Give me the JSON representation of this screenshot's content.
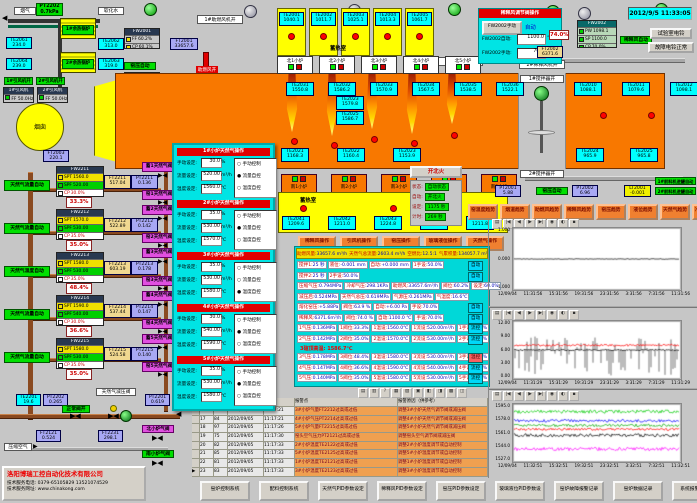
{
  "window": {
    "datetime": "2012/9/5 11:33:05"
  },
  "colors": {
    "bg": "#c6c6c6",
    "furnace": "#f87800",
    "regen_yellow": "#ffff00",
    "sensor_cyan": "#00ffff",
    "sensor_purple": "#a8a8f4",
    "auto_green": "#00e000",
    "alarm_red": "#e00000",
    "trend_btn_orange": "#f08030",
    "popup_cyan": "#00e4e4"
  },
  "glyphs": {
    "valve": "▶◀",
    "arrow_left": "◀",
    "arrow_right": "▶"
  },
  "top_left": {
    "flue_gas": "烟气",
    "soft_water": "软化水",
    "chimney": "烟囱",
    "kiln_auto": "窑压自动",
    "comb_air_on": "助燃风开",
    "comb_fan_on": "1#助燃风机开",
    "pt2202": {
      "id": "PT2202",
      "v": "0.7kPa"
    },
    "boiler1": "1#余热锅炉",
    "boiler2": "2#余热锅炉",
    "te2061": {
      "id": "TE2061",
      "v": "234.0"
    },
    "te2064": {
      "id": "TE2064",
      "v": "239.0"
    },
    "te2062": {
      "id": "TE2062",
      "v": "313.0"
    },
    "te2063": {
      "id": "TE2063",
      "v": "319.0"
    },
    "ft2003": {
      "id": "FT2003",
      "v": "220.1"
    },
    "te2053": {
      "id": "TE2053",
      "v": "745.7"
    },
    "ft2001": {
      "id": "FT2001",
      "v": "33657.6"
    },
    "fan1_on": "1#引风机开",
    "fan2_on": "2#引风机开",
    "fan1": {
      "name": "1#引风机",
      "rows": [
        {
          "k": "FF",
          "v": "50.0Hz"
        }
      ]
    },
    "fan2": {
      "name": "2#引风机",
      "rows": [
        {
          "k": "FF",
          "v": "50.0Hz"
        }
      ]
    },
    "fw2001_top": {
      "title": "FW2001",
      "rows": [
        {
          "k": "FF",
          "v": "60.2%"
        },
        {
          "k": "CP",
          "v": "60.1%"
        }
      ]
    },
    "fw2001": {
      "title": "FW2001",
      "rows": [
        {
          "k": "PF",
          "v": "5.88"
        },
        {
          "k": "SP",
          "v": "6.00"
        },
        {
          "k": "OP",
          "v": "78.0%"
        }
      ]
    },
    "valve_pos": "63.9%"
  },
  "furnace": {
    "regen_label": "蓄热室",
    "south_regen_label": "蓄热室",
    "regen_top": [
      {
        "id": "TE2001",
        "v": "1040.1"
      },
      {
        "id": "TE2002",
        "v": "1011.7"
      },
      {
        "id": "TE2003",
        "v": "1025.1"
      },
      {
        "id": "TE2004",
        "v": "1013.3"
      },
      {
        "id": "TE2005",
        "v": "1061.7"
      }
    ],
    "north_ports": [
      "北1小炉",
      "北2小炉",
      "北3小炉",
      "北4小炉",
      "北5小炉"
    ],
    "south_ports": [
      "南1小炉",
      "南2小炉",
      "南3小炉",
      "南4小炉",
      "南5小炉"
    ],
    "crown_temps": [
      {
        "id": "TE2031",
        "v": "1550.8"
      },
      {
        "id": "TE2032",
        "v": "1586.2"
      },
      {
        "id": "TE2033",
        "v": "1570.9"
      },
      {
        "id": "TE2034",
        "v": "1567.5"
      },
      {
        "id": "TE2035",
        "v": "1538.5"
      },
      {
        "id": "TE2036",
        "v": "1522.1"
      }
    ],
    "right_temps": [
      {
        "id": "TE2010",
        "v": "1088.1"
      },
      {
        "id": "TE2011",
        "v": "1079.6"
      },
      {
        "id": "TE2012",
        "v": "1098.1"
      }
    ],
    "mid_temps": [
      {
        "id": "TE2023",
        "v": "1579.8"
      },
      {
        "id": "TE2025",
        "v": "1586.7"
      }
    ],
    "bottom_temps": [
      {
        "id": "TE2021",
        "v": "1168.3"
      },
      {
        "id": "TE2022",
        "v": "1160.4"
      },
      {
        "id": "TE2023",
        "v": "1153.9"
      }
    ],
    "bottom_temps2": [
      {
        "id": "TE2024",
        "v": "965.9"
      },
      {
        "id": "TE2025",
        "v": "965.8"
      }
    ],
    "south_regen": [
      {
        "id": "TE2041",
        "v": "1209.6"
      },
      {
        "id": "TE2042",
        "v": "1211.0"
      },
      {
        "id": "TE2043",
        "v": "1224.8"
      },
      {
        "id": "TE2044",
        "v": "1212.8"
      },
      {
        "id": "TE2045",
        "v": "1211.8"
      }
    ],
    "mixer1": "1#搅拌器开",
    "mixer2": "2#搅拌器开",
    "dil1": "1#稀释风机开",
    "dil2": "2#稀释风机开"
  },
  "top_right": {
    "panel": {
      "title": "稀释风调节阀操作",
      "btn": "FW2002手动",
      "mode": "自动",
      "auto_label": "FW2002自动:",
      "auto_value": "1100.0",
      "auto_unit": "℃",
      "man_label": "FW2002手动:",
      "man_value": "70.0",
      "man_unit": "%"
    },
    "fw2002": {
      "title": "FW2002",
      "rows": [
        {
          "k": "PW",
          "v": "1098.1"
        },
        {
          "k": "SP",
          "v": "1100.0"
        },
        {
          "k": "CP",
          "v": "70.0%"
        }
      ]
    },
    "valve_pos": "74.0%",
    "ft2002": {
      "id": "FT2002",
      "v": "6371.6"
    },
    "dilution_auto": "稀释风自动",
    "bell_test": "试验室电铃",
    "bell_ok": "故障电铃正常"
  },
  "level_group": {
    "pt2001": {
      "id": "PT2001",
      "v": "5.88"
    },
    "kiln_auto": "窑压自动",
    "pt2002": {
      "id": "PT2002",
      "v": "6.96"
    },
    "lt2001": {
      "id": "LT2001",
      "v": "-0.001"
    },
    "feeder1": "1#前料机进罐自动",
    "feeder2": "2#前料机进罐自动"
  },
  "fire_control": {
    "button": "开北火",
    "rows": [
      {
        "k": "状态:",
        "v": "自动状态"
      },
      {
        "k": "自动:",
        "v": "开北火"
      },
      {
        "k": "设定:",
        "v": "1175 秒"
      },
      {
        "k": "计时:",
        "v": "269 秒"
      }
    ]
  },
  "op_buttons": [
    "稀释风操作",
    "引风机操作",
    "窑压操作",
    "玻璃液位操作",
    "天然气操作"
  ],
  "trend_buttons": [
    "窑温度趋势",
    "烟道趋势",
    "助燃风趋势",
    "稀释风趋势",
    "窑压趋势",
    "液位趋势",
    "天然气趋势",
    "冷却气趋势"
  ],
  "gas_loops": [
    {
      "auto": "天然气流量自动",
      "fw": "FW2211",
      "rows": [
        {
          "k": "SPT",
          "v": "1560.0"
        },
        {
          "k": "SPF",
          "v": "520.00"
        },
        {
          "k": "CP",
          "v": "30.0%"
        }
      ],
      "ft": {
        "id": "FT2211",
        "v": "517.04"
      },
      "pt": {
        "id": "PT2211",
        "v": "0.136"
      },
      "pos": "33.3%",
      "valve_top": "蓄1天然气阀",
      "valve_bottom": "窑1天然气阀"
    },
    {
      "auto": "天然气流量自动",
      "fw": "FW2212",
      "rows": [
        {
          "k": "SPT",
          "v": "1570.0"
        },
        {
          "k": "SPF",
          "v": "530.00"
        },
        {
          "k": "CP",
          "v": "35.0%"
        }
      ],
      "ft": {
        "id": "FT2212",
        "v": "522.89"
      },
      "pt": {
        "id": "PT2212",
        "v": "0.142"
      },
      "pos": "35.0%",
      "valve_top": "蓄2天然气阀",
      "valve_bottom": "窑2天然气阀"
    },
    {
      "auto": "天然气温度自动",
      "fw": "FW2213",
      "rows": [
        {
          "k": "SPT",
          "v": "1580.0"
        },
        {
          "k": "SPF",
          "v": "530.00"
        },
        {
          "k": "CP",
          "v": "35.0%"
        }
      ],
      "ft": {
        "id": "FT2213",
        "v": "603.19"
      },
      "pt": {
        "id": "PT2213",
        "v": "0.178"
      },
      "pos": "48.4%",
      "valve_top": "蓄3天然气阀",
      "valve_bottom": "窑3天然气阀"
    },
    {
      "auto": "天然气流量自动",
      "fw": "FW2214",
      "rows": [
        {
          "k": "SPT",
          "v": "1590.0"
        },
        {
          "k": "SPF",
          "v": "540.00"
        },
        {
          "k": "CP",
          "v": "30.0%"
        }
      ],
      "ft": {
        "id": "FT2214",
        "v": "537.44"
      },
      "pt": {
        "id": "PT2214",
        "v": "0.147"
      },
      "pos": "36.6%",
      "valve_top": "蓄4天然气阀",
      "valve_bottom": "窑4天然气阀"
    },
    {
      "auto": "天然气流量自动",
      "fw": "FW2215",
      "rows": [
        {
          "k": "SPT",
          "v": "1580.0"
        },
        {
          "k": "SPF",
          "v": "530.00"
        },
        {
          "k": "CP",
          "v": "35.0%"
        }
      ],
      "ft": {
        "id": "FT2215",
        "v": "524.58"
      },
      "pt": {
        "id": "PT2215",
        "v": "0.140"
      },
      "pos": "35.0%",
      "valve_top": "蓄5天然气阀",
      "valve_bottom": "窑5天然气阀"
    }
  ],
  "popup": {
    "labels": {
      "manual": "手动设定:",
      "flow": "流量设定:",
      "temp": "温度设定:",
      "um": "%",
      "uf": "m³/h",
      "ut": "℃"
    },
    "sections": [
      {
        "title": "1#小炉天然气操作",
        "manual": "30.0",
        "flow": "520.00",
        "temp": "1560.0",
        "radios": [
          {
            "s": "○",
            "l": "手动控制"
          },
          {
            "s": "●",
            "l": "流量自控"
          },
          {
            "s": "○",
            "l": "温度自控"
          }
        ]
      },
      {
        "title": "2#小炉天然气操作",
        "manual": "35.0",
        "flow": "530.00",
        "temp": "1570.0",
        "radios": [
          {
            "s": "○",
            "l": "手动控制"
          },
          {
            "s": "●",
            "l": "流量自控"
          },
          {
            "s": "○",
            "l": "温度自控"
          }
        ]
      },
      {
        "title": "3#小炉天然气操作",
        "manual": "35.0",
        "flow": "530.00",
        "temp": "1580.0",
        "radios": [
          {
            "s": "○",
            "l": "手动控制"
          },
          {
            "s": "○",
            "l": "流量自控"
          },
          {
            "s": "●",
            "l": "温度自控"
          }
        ]
      },
      {
        "title": "4#小炉天然气操作",
        "manual": "30.0",
        "flow": "540.00",
        "temp": "1590.0",
        "radios": [
          {
            "s": "○",
            "l": "手动控制"
          },
          {
            "s": "●",
            "l": "流量自控"
          },
          {
            "s": "○",
            "l": "温度自控"
          }
        ]
      },
      {
        "title": "5#小炉天然气操作",
        "manual": "35.0",
        "flow": "530.00",
        "temp": "1580.0",
        "radios": [
          {
            "s": "○",
            "l": "手动控制"
          },
          {
            "s": "●",
            "l": "流量自控"
          },
          {
            "s": "○",
            "l": "温度自控"
          }
        ]
      }
    ]
  },
  "banner": {
    "items": [
      {
        "k": "助燃风量:",
        "v": "33657.6 m³/h"
      },
      {
        "k": "天然气总流量:",
        "v": "2603.4 m³/h"
      },
      {
        "k": "空燃比:",
        "v": "12.5:1"
      },
      {
        "k": "气累积量:",
        "v": "134057.7 m³"
      }
    ]
  },
  "grid": {
    "rows": [
      [
        {
          "k": "搅拌1:",
          "v": "25 秒"
        },
        {
          "k": "液位:",
          "v": "-0.001 mm"
        },
        {
          "k": "自动:",
          "v": "+0.000 mm"
        },
        {
          "k": "1手设:",
          "v": "50.0%"
        }
      ],
      [
        {
          "k": "搅拌2:",
          "v": "25 秒"
        },
        {
          "k": "2手设:",
          "v": "50.0%"
        }
      ],
      [
        {
          "k": "压缩气压:",
          "v": "0.794MPa"
        },
        {
          "k": "冷却气压:",
          "v": "298.1KPa"
        },
        {
          "k": "助燃风:",
          "v": "33657.6m³/h"
        },
        {
          "k": "阀位:",
          "v": "60.2%"
        },
        {
          "k": "设定:",
          "v": "60.0%"
        }
      ],
      [
        {
          "k": "减压后:",
          "v": "0.524MPa"
        },
        {
          "k": "天然气总压:",
          "v": "0.619MPa"
        },
        {
          "k": "气源压:",
          "v": "0.261MPa"
        },
        {
          "k": "气温度:",
          "v": "16.6℃"
        }
      ],
      [
        {
          "k": "熔化窑压:",
          "v": "+5.88Pa"
        },
        {
          "k": "阀位:",
          "v": "63.9 %"
        },
        {
          "k": "自动:",
          "v": "+6.00 Pa"
        },
        {
          "k": "手设:",
          "v": "70.0%"
        }
      ],
      [
        {
          "k": "稀释风:",
          "v": "6371.6m³/h"
        },
        {
          "k": "阀位:",
          "v": "74.0 %"
        },
        {
          "k": "自动:",
          "v": "1100.0 ℃"
        },
        {
          "k": "手设:",
          "v": "70.0%"
        }
      ],
      [
        {
          "k": "1气压:",
          "v": "0.136MPa"
        },
        {
          "k": "1阀位:",
          "v": "33.3%"
        },
        {
          "k": "1温设:",
          "v": "1560.0℃"
        },
        {
          "k": "1流设:",
          "v": "520.00m³/h"
        },
        {
          "k": "1手设:",
          "v": "30.0%"
        }
      ],
      [
        {
          "k": "2气压:",
          "v": "0.142MPa"
        },
        {
          "k": "2阀位:",
          "v": "35.0%"
        },
        {
          "k": "2温设:",
          "v": "1570.0℃"
        },
        {
          "k": "2流设:",
          "v": "530.00m³/h"
        },
        {
          "k": "2手设:",
          "v": "35.0%"
        }
      ],
      [
        {
          "k": "3气压:",
          "v": "0.178MPa"
        },
        {
          "k": "3阀位:",
          "v": "48.4%"
        },
        {
          "k": "3温设:",
          "v": "1580.0℃"
        },
        {
          "k": "3流设:",
          "v": "530.00m³/h"
        },
        {
          "k": "3手设:",
          "v": "35.0%"
        }
      ],
      [
        {
          "k": "4气压:",
          "v": "0.147MPa"
        },
        {
          "k": "4阀位:",
          "v": "36.6%"
        },
        {
          "k": "4温设:",
          "v": "1590.0℃"
        },
        {
          "k": "4流设:",
          "v": "540.00m³/h"
        },
        {
          "k": "4手设:",
          "v": "30.0%"
        }
      ],
      [
        {
          "k": "5气压:",
          "v": "0.140MPa"
        },
        {
          "k": "5阀位:",
          "v": "35.0%"
        },
        {
          "k": "5温设:",
          "v": "1580.0℃"
        },
        {
          "k": "5流设:",
          "v": "530.00m³/h"
        },
        {
          "k": "5手设:",
          "v": "35.0%"
        }
      ]
    ],
    "chips": [
      "自动",
      "自动",
      "",
      "",
      "自动",
      "自动",
      "流控",
      "流控",
      "温控",
      "流控",
      "流控"
    ],
    "alarm_note": "3碹顶高温: 1586.7℃"
  },
  "alarm": {
    "col_point": "报警点",
    "col_reason": "报警原因（供参考）",
    "toolbar_icons": [
      "▤",
      "▥",
      "?",
      "▦",
      "▧",
      "▣",
      "◧",
      "◨",
      "▩",
      "◫"
    ],
    "rows": [
      {
        "m": "",
        "n": "16",
        "c": "98",
        "d": "2012/09/05",
        "t": "11:17:21",
        "p": "3#小炉气量FT2212过高或过低",
        "r": "调整3#小炉天然气调节阀或减压阀"
      },
      {
        "m": "",
        "n": "17",
        "c": "84",
        "d": "2012/09/05",
        "t": "11:17:21",
        "p": "4#小炉气压PT2214过高或过低",
        "r": "调整4#小炉天然气调节阀或减压阀"
      },
      {
        "m": "",
        "n": "18",
        "c": "97",
        "d": "2012/09/05",
        "t": "11:17:26",
        "p": "5#小炉气量FT2215过高或过低",
        "r": "调整5#小炉天然气调节阀或减压阀"
      },
      {
        "m": "",
        "n": "19",
        "c": "75",
        "d": "2012/09/05",
        "t": "11:17:30",
        "p": "窑头空气压力PT2121过高或过低",
        "r": "调整窑头空气调节阀或减压阀"
      },
      {
        "m": "",
        "n": "20",
        "c": "82",
        "d": "2012/09/05",
        "t": "11:17:33",
        "p": "2#小炉温度TE2122过高或过低",
        "r": "调整2#小炉温度调节或自动控制"
      },
      {
        "m": "",
        "n": "21",
        "c": "85",
        "d": "2012/09/05",
        "t": "11:17:33",
        "p": "5#小炉温度TE2125过高或过低",
        "r": "调整5#小炉温度调节或自动控制"
      },
      {
        "m": "",
        "n": "22",
        "c": "81",
        "d": "2012/09/05",
        "t": "11:17:33",
        "p": "1#小炉温度TE2121过高或过低",
        "r": "调整1#小炉温度调节或自动控制"
      },
      {
        "m": "▶",
        "n": "23",
        "c": "83",
        "d": "2012/09/05",
        "t": "11:17:33",
        "p": "3#小炉温度TE2123过高或过低",
        "r": "调整3#小炉温度调节或自动控制"
      }
    ]
  },
  "charts_toolbar_icons": [
    "▤",
    "|◀",
    "◀",
    "▶",
    "▶|",
    "◉",
    "◐",
    "▪"
  ],
  "chart_data": [
    {
      "type": "line",
      "ylim": [
        -1,
        1
      ],
      "yticks": [
        "1.000",
        "0.000",
        "-1.000"
      ],
      "xticks": [
        "12/09/04",
        "11:31:56",
        "15:31:56",
        "19:31:56",
        "23:31:56",
        "3:31:56",
        "7:31:56",
        "11:31:56"
      ],
      "grid": false,
      "legend": false,
      "series": [
        {
          "color": "#000000",
          "approx_value": 0.0,
          "noise": 0.012
        }
      ]
    },
    {
      "type": "line",
      "ylim": [
        0,
        12
      ],
      "yticks": [
        "12.00",
        "9.00",
        "6.00",
        "3.00",
        "0.00"
      ],
      "xticks": [
        "12/09/04",
        "11:31:29",
        "15:31:29",
        "19:31:29",
        "23:31:29",
        "3:31:29",
        "7:31:29",
        "11:31:29"
      ],
      "grid": false,
      "legend": false,
      "series": [
        {
          "color": "#404040",
          "approx_value": 6.0,
          "noise": 3.5,
          "style": "spikes",
          "up": 3.3,
          "dn": 6.0
        },
        {
          "color": "#ff0000",
          "approx_value": 7.1,
          "noise": 0.25
        },
        {
          "color": "#000000",
          "approx_value": 6.0,
          "noise": 0.15
        }
      ]
    },
    {
      "type": "line",
      "ylim": [
        1527,
        1595
      ],
      "yticks": [
        "1595.0",
        "1578.0",
        "1561.0",
        "1544.0",
        "1527.0"
      ],
      "xticks": [
        "12/09/04",
        "11:32:51",
        "15:32:51",
        "19:32:51",
        "23:32:51",
        "3:32:51",
        "7:32:51",
        "11:32:51"
      ],
      "grid": false,
      "legend": false,
      "series": [
        {
          "color": "#00cc00",
          "approx_value": 1589,
          "noise": 2.2
        },
        {
          "color": "#0000ff",
          "approx_value": 1577,
          "noise": 1.8
        },
        {
          "color": "#00aa00",
          "approx_value": 1571,
          "noise": 1.8
        },
        {
          "color": "#ff0000",
          "approx_value": 1566,
          "noise": 1.5
        },
        {
          "color": "#000000",
          "approx_value": 1558,
          "noise": 2.0
        },
        {
          "color": "#ff00ff",
          "approx_value": 1540,
          "noise": 2.2
        }
      ]
    }
  ],
  "bottom_left_pipes": {
    "te2201": {
      "id": "TE2201",
      "v": "19.6"
    },
    "pt2202b": {
      "id": "PT2202",
      "v": "0.265"
    },
    "pt2201": {
      "id": "PT2201",
      "v": "0.619"
    },
    "ft2121": {
      "id": "FT2121",
      "v": "0.524"
    },
    "ft2231": {
      "id": "FT2231",
      "v": "298.1"
    },
    "reducer": "天然气减压阀",
    "valve_ok": "正常阀开",
    "compressed_air": "压缩空气",
    "north_valve": "北小炉气阀",
    "south_valve": "南小炉气阀"
  },
  "company": {
    "name": "洛阳博瑞工控自动化技术有限公司",
    "phone": "技术服务电话: 0379-65105829  13521074529",
    "web": "技术服务网址: www.chinakong.com"
  },
  "bottom_buttons": [
    "窑炉控制系统",
    "配料控制系统",
    "天然气PID参数设定",
    "稀释风PID参数设定",
    "窑压PID参数设定",
    "玻璃液位PID参数设定",
    "窑炉故障报警记录",
    "窑炉数据记录",
    "系统报警值设定"
  ]
}
